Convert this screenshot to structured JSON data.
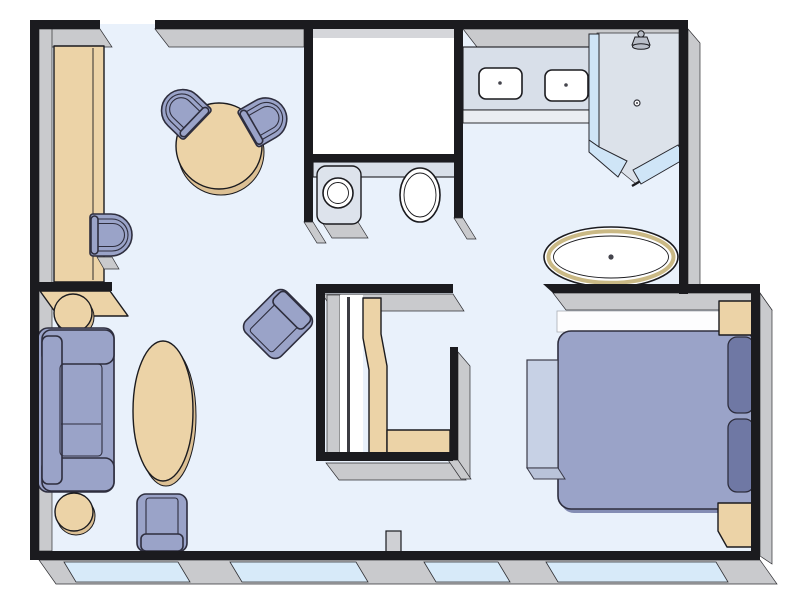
{
  "meta": {
    "type": "floor-plan",
    "view": "top-down suite layout"
  },
  "palette": {
    "outside": "#ffffff",
    "floor": "#e9f1fb",
    "wall_line": "#1b1b1f",
    "wall_face": "#c9cacd",
    "window_glass": "#d7eaf9",
    "glass": "#cfe5f7",
    "furniture_blue": "#9aa3c8",
    "furniture_blue_dark": "#6f78a4",
    "furniture_outline": "#2e2e3e",
    "tan": "#ecd3a7",
    "tan_shadow": "#dcc094",
    "fixture_white": "#ffffff",
    "fixture_gray": "#dde3ec",
    "counter": "#d8dfe9",
    "counter_edge": "#eaedf2",
    "shower_floor": "#dce2ea",
    "bench_blue": "#c7d1e5",
    "bench_foot": "#b9c3d9",
    "tub_rim": "#cab985",
    "closet_white": "#ffffff",
    "metal_gray": "#cfd0d4"
  },
  "plan": {
    "rooms": [
      {
        "id": "entry-dining",
        "name": "Entry / Dining",
        "furniture": [
          "long desk",
          "desk chair",
          "round dining table",
          "dining chair",
          "dining chair"
        ]
      },
      {
        "id": "water-closet",
        "name": "Water closet",
        "furniture": [
          "enclosed closet room",
          "wash basin",
          "toilet"
        ]
      },
      {
        "id": "bathroom",
        "name": "Bathroom",
        "furniture": [
          "double-sink vanity",
          "walk-in shower",
          "oval bathtub"
        ]
      },
      {
        "id": "living-room",
        "name": "Living room",
        "furniture": [
          "sofa",
          "side table",
          "side table",
          "oval coffee table",
          "armchair",
          "accent armchair",
          "console shelf"
        ]
      },
      {
        "id": "wardrobe",
        "name": "Wardrobe unit",
        "furniture": [
          "wardrobe panel",
          "shelf"
        ]
      },
      {
        "id": "bedroom",
        "name": "Bedroom",
        "furniture": [
          "double bed",
          "pillow",
          "pillow",
          "nightstand",
          "nightstand",
          "foot bench",
          "headboard shelf"
        ]
      },
      {
        "id": "window-wall",
        "name": "Window wall",
        "furniture": [
          "window",
          "window",
          "window",
          "window",
          "mullion pillar"
        ]
      }
    ]
  }
}
